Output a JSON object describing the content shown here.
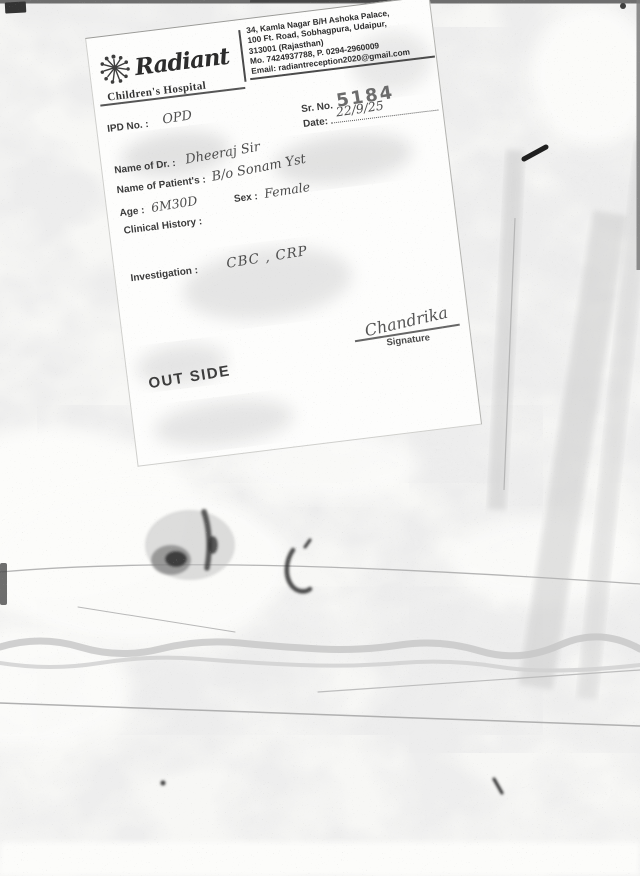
{
  "document": {
    "clinic": {
      "name": "Radiant",
      "subtitle": "Children's Hospital",
      "address_lines": [
        "34, Kamla Nagar B/H Ashoka Palace,",
        "100 Ft. Road, Sobhagpura, Udaipur,",
        "313001 (Rajasthan)",
        "Mo. 7424937788, P. 0294-2960009",
        "Email: radiantreception2020@gmail.com"
      ]
    },
    "ipd": {
      "label": "IPD No. :",
      "value": "OPD"
    },
    "serial": {
      "label": "Sr. No.",
      "value": "5184"
    },
    "date": {
      "label": "Date:",
      "value": "22/9/25"
    },
    "doctor": {
      "label": "Name of Dr. :",
      "value": "Dheeraj Sir"
    },
    "patient": {
      "label": "Name of Patient's :",
      "value": "B/o Sonam Yst"
    },
    "age": {
      "label": "Age :",
      "value": "6M30D"
    },
    "sex": {
      "label": "Sex :",
      "value": "Female"
    },
    "clinical_history": {
      "label": "Clinical History :"
    },
    "investigation": {
      "label": "Investigation :",
      "value": "CBC , CRP"
    },
    "signature": {
      "handwritten": "Chandrika",
      "label": "Signature"
    },
    "stamp": "OUT SIDE"
  },
  "colors": {
    "ink": "#2e2e2e",
    "stamp_gray": "#6c6c6c",
    "scan_noise_gray": "#d7d7d7",
    "paper": "#fdfdfc"
  }
}
